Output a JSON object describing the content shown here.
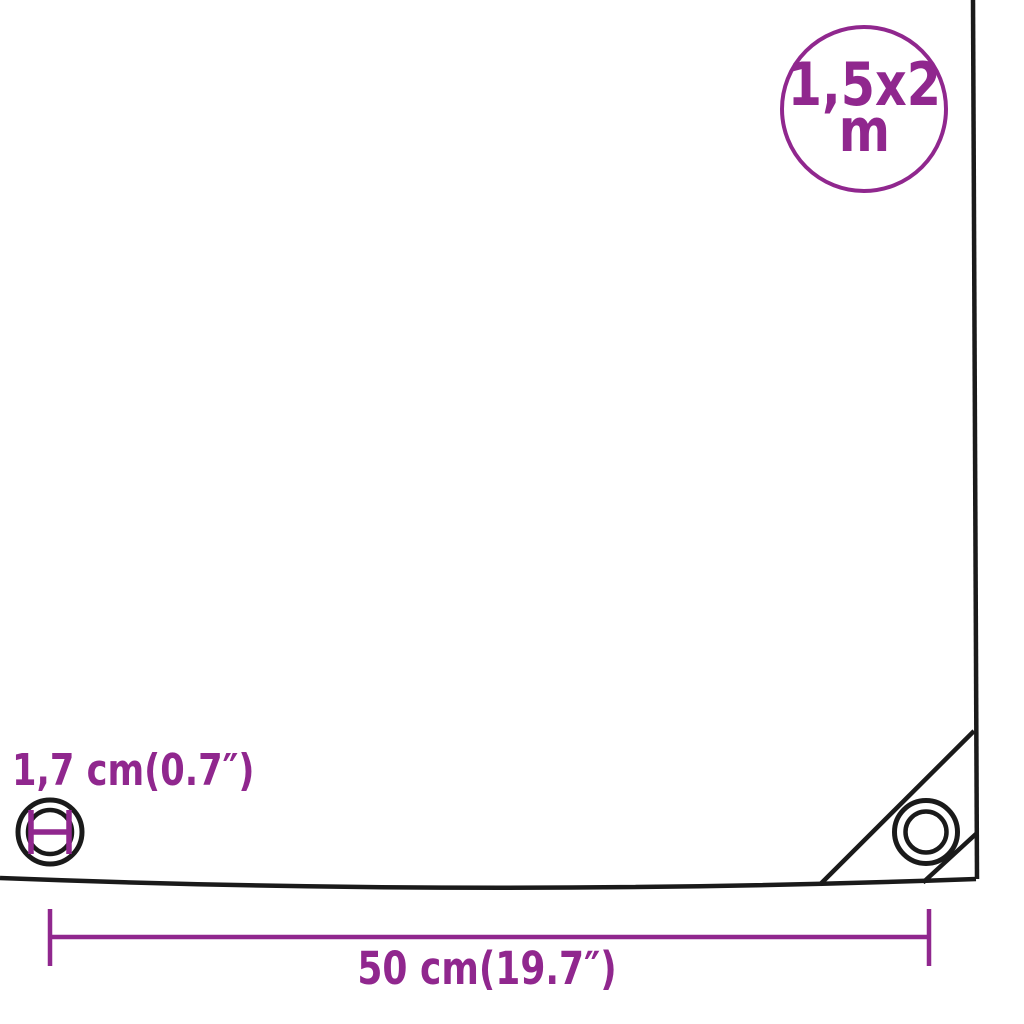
{
  "badge": {
    "line1": "1,5x2",
    "line2": "m"
  },
  "labels": {
    "grommet_diameter": "1,7 cm(0.7″)",
    "grommet_spacing": "50 cm(19.7″)"
  },
  "colors": {
    "accent_purple": "#90278E",
    "line_black": "#1A1A1A",
    "background": "#FFFFFF"
  },
  "icons": {
    "left_icon": "grommet-diameter-icon",
    "right_icon": "corner-grommet-icon",
    "measure_icon": "dimension-line-icon"
  }
}
